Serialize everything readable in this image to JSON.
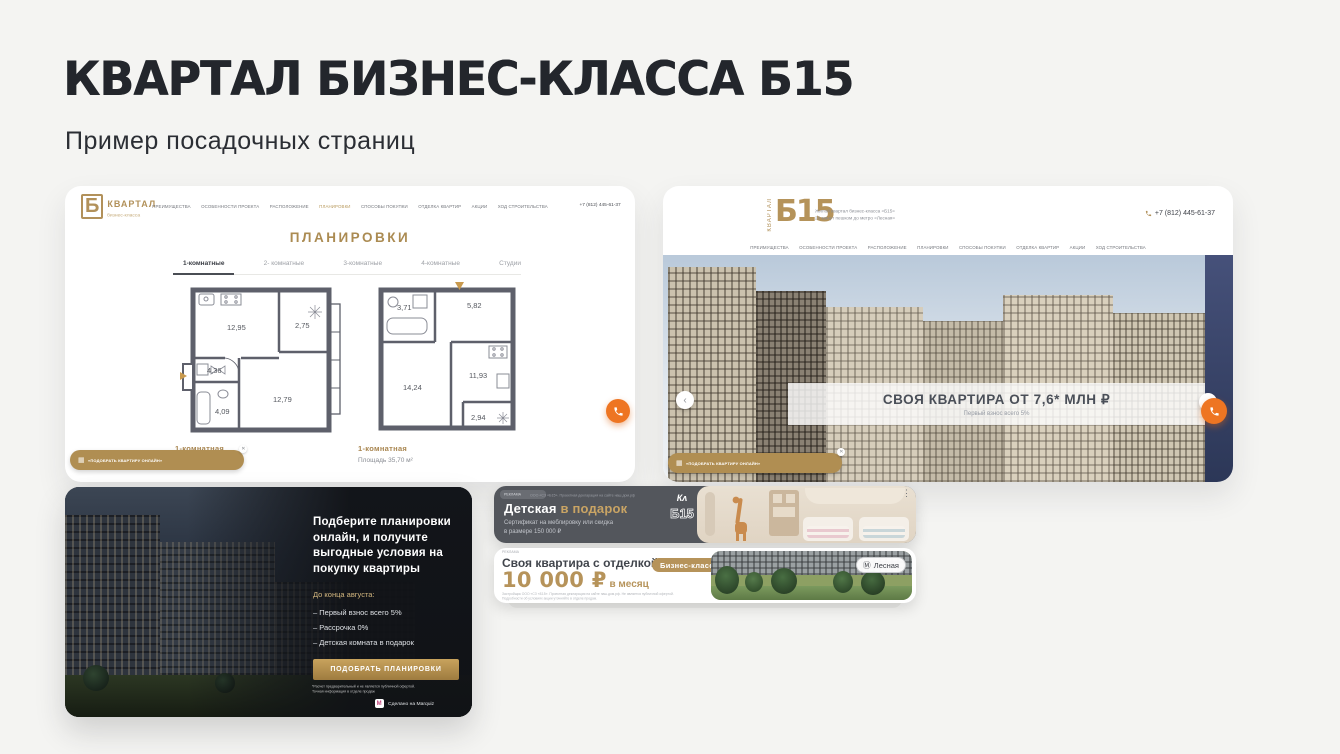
{
  "slide": {
    "title": "КВАРТАЛ БИЗНЕС-КЛАССА Б15",
    "subtitle": "Пример посадочных страниц"
  },
  "colors": {
    "gold": "#b2915a",
    "orange": "#ee7522",
    "dark_card": "#15171b",
    "banner_dark": "#53565c"
  },
  "site1": {
    "logo": {
      "mark": "Б",
      "title": "КВАРТАЛ",
      "subtitle": "бизнес-класса"
    },
    "nav": [
      "ПРЕИМУЩЕСТВА",
      "ОСОБЕННОСТИ ПРОЕКТА",
      "РАСПОЛОЖЕНИЕ",
      "ПЛАНИРОВКИ",
      "СПОСОБЫ ПОКУПКИ",
      "ОТДЕЛКА КВАРТИР",
      "АКЦИИ",
      "ХОД СТРОИТЕЛЬСТВА"
    ],
    "phone": "+7 (812) 445-61-37",
    "section_title": "ПЛАНИРОВКИ",
    "tabs": [
      "1-комнатные",
      "2- комнатные",
      "3-комнатные",
      "4-комнатные",
      "Студии"
    ],
    "active_tab": "1-комнатные",
    "cta": "«ПОДОБРАТЬ КВАРТИРУ ОНЛАЙН»",
    "plan1": {
      "name": "1-комнатная",
      "area": "Площадь 34,19 м²",
      "rooms": {
        "kitchen": "12,95",
        "balcony": "2,75",
        "hall": "4,36",
        "bath": "4,09",
        "living": "12,79"
      }
    },
    "plan2": {
      "name": "1-комнатная",
      "area": "Площадь 35,70 м²",
      "rooms": {
        "bath": "3,71",
        "hall": "5,82",
        "living": "14,24",
        "kitchen": "11,93",
        "balcony": "2,94"
      }
    }
  },
  "site2": {
    "logo_mark": "Б15",
    "logo_vertical": "КВАРТАЛ",
    "tagline_line1": "Жилой квартал бизнес-класса «Б15»",
    "tagline_line2": "20 минут пешком до метро «Лесная»",
    "phone": "+7 (812) 445-61-37",
    "nav": [
      "ПРЕИМУЩЕСТВА",
      "ОСОБЕННОСТИ ПРОЕКТА",
      "РАСПОЛОЖЕНИЕ",
      "ПЛАНИРОВКИ",
      "СПОСОБЫ ПОКУПКИ",
      "ОТДЕЛКА КВАРТИР",
      "АКЦИИ",
      "ХОД СТРОИТЕЛЬСТВА"
    ],
    "hero_title": "СВОЯ КВАРТИРА ОТ 7,6* МЛН ₽",
    "hero_subtitle": "Первый взнос всего 5%",
    "cta": "«ПОДОБРАТЬ КВАРТИРУ ОНЛАЙН»"
  },
  "quiz_card": {
    "heading": "Подберите планировки онлайн, и получите выгодные условия на покупку квартиры",
    "deadline": "До конца августа:",
    "bullets": [
      "– Первый взнос всего 5%",
      "– Рассрочка 0%",
      "– Детская комната в подарок"
    ],
    "button": "ПОДОБРАТЬ ПЛАНИРОВКИ",
    "disclaimer": "*Расчет предварительный и не является публичной офертой. Точная информация в отделе продаж",
    "made_on": "Сделано на Marquiz"
  },
  "banner_dark": {
    "ad_badge": "РЕКЛАМА",
    "ad_note": "ООО «СЗ «Б15». Проектная декларация на сайте наш.дом.рф",
    "title_main": "Детская",
    "title_accent": "в подарок",
    "subtitle_line1": "Сертификат на меблировку или скидка",
    "subtitle_line2": "в размере 150 000 ₽",
    "logo_script": "Кʌ",
    "logo_mark": "Б15"
  },
  "banner_light": {
    "ad_label": "РЕКЛАМА",
    "title": "Своя квартира с отделкой за",
    "price": "10 000 ₽",
    "price_suffix": " в месяц",
    "class_badge": "Бизнес-класс",
    "metro_icon": "Ⓜ",
    "metro_badge": "Лесная",
    "disclaimer_line1": "Застройщик ООО «СЗ «Б15». Проектная декларация на сайте наш.дом.рф. Не является публичной офертой.",
    "disclaimer_line2": "Подробности об условиях акции уточняйте в отделе продаж."
  }
}
